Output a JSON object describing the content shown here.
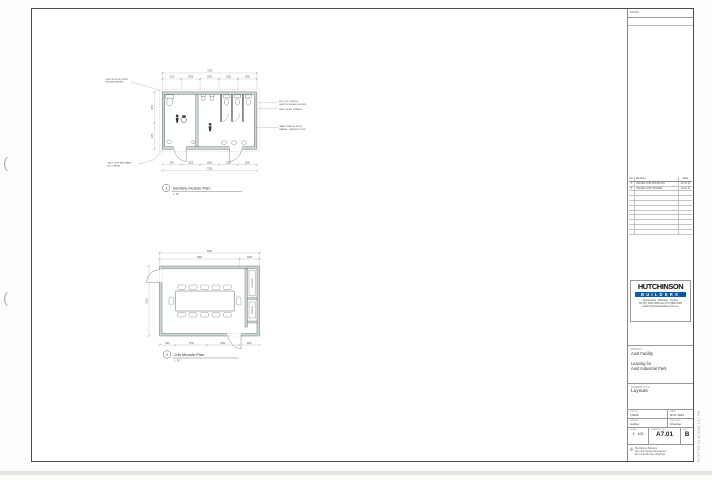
{
  "plans": {
    "sanitary": {
      "tag_number": "1",
      "title": "Sanitary Module Plan",
      "scale": "1 : 50",
      "dims": {
        "top_overall": "7200",
        "top_segments": [
          "1200",
          "1500",
          "1500",
          "1500",
          "1500"
        ],
        "left_segments": [
          "1650",
          "1050"
        ],
        "bottom_segments": [
          "900",
          "1500",
          "1800",
          "1500",
          "1500"
        ],
        "bottom_overall": "7200"
      },
      "notes": {
        "roof1": "LINE OF ROOF OVER",
        "roof2": "SHOWN DASHED",
        "ramp1": "GALV STEP AND RAMP",
        "ramp2": "BY OTHERS",
        "part1": "FULL HT CUBICLE",
        "part2": "PARTITIONS AND DOORS",
        "urinals": "WALL HUNG URINALS",
        "vanity1": "VANITY BENCH WITH",
        "vanity2": "BASINS + MIRROR OVER"
      }
    },
    "crib": {
      "tag_number": "2",
      "title": "Crib Module Plan",
      "scale": "1 : 50",
      "dims": {
        "top_overall": "6000",
        "top_seg1": "4800",
        "top_seg2": "1200",
        "left_overall": "3000",
        "bottom_segments": [
          "900",
          "1750",
          "1950",
          "1200"
        ]
      },
      "rooms": {
        "lockers": "LOCKERS",
        "fridge": "FRIDGE"
      }
    }
  },
  "title_block": {
    "notes_label": "NOTES",
    "revisions": {
      "headers": [
        "No.",
        "Revision",
        "Date"
      ],
      "rows": [
        {
          "no": "A",
          "desc": "ISSUED FOR APPROVAL",
          "date": "21.10.11"
        },
        {
          "no": "B",
          "desc": "ISSUED FOR TENDER",
          "date": "04.11.11"
        }
      ]
    },
    "logo": {
      "word1": "HUTCHINSON",
      "word2": "BUILDERS",
      "contact1": "Toowoomba  .  Brisbane  .  Sydney",
      "contact2": "Tel (07) 4600 0000   Fax (07) 4600 0000",
      "contact3": "www.hutchinsonbuilders.com.au"
    },
    "project": {
      "label": "PROJECT",
      "client": "Aust Facility",
      "for1": "Leasing for",
      "for2": "Aust Industrial Park",
      "title_label": "DRAWING TITLE",
      "title": "Layouts"
    },
    "meta": {
      "job_label": "JOB No.",
      "job": "13309",
      "date_label": "DATE",
      "date": "NOV 2011",
      "drawn_label": "DRAWN",
      "drawn": "Author",
      "checked_label": "CHECKED",
      "checked": "Checker",
      "scale_label": "SCALE",
      "scale": "1 : 100",
      "dwg_label": "DRAWING No.",
      "dwg": "A7.01",
      "rev_label": "REV",
      "rev": "B"
    },
    "copyright": {
      "symbol": "©",
      "line1": "Hutchinson Builders",
      "line2": "Use only figured dimensions.",
      "line3": "Do not scale from drawings."
    }
  },
  "stamp": "PLOTTED 04.11.2011  4:17 PM"
}
